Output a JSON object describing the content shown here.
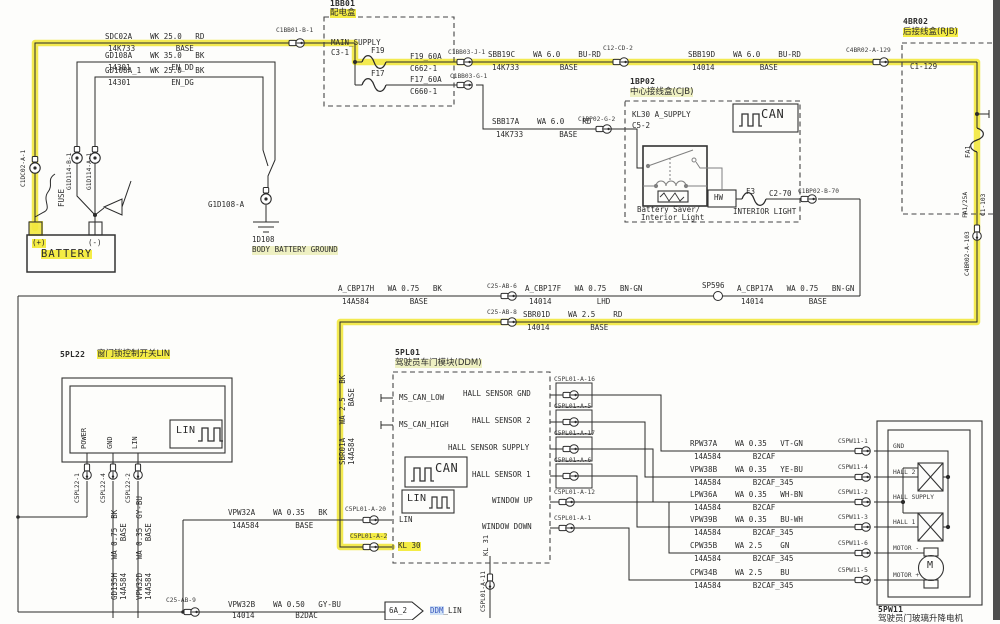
{
  "colors": {
    "highlight": "#f2e83d",
    "highlight_soft": "#eef0c2",
    "wire": "#2a2a2a",
    "link_blue": "#3d5bc0"
  },
  "tl": {
    "sdc02a_l1": "SDC02A    WK 25.0   RD",
    "sdc02a_l2": "14K733         BASE",
    "gd108a_l1": "GD108A    WK 35.0   BK",
    "gd108a_l2": "14301         EN_DD",
    "gd108a1_l1": "GD108A_1  WK 25.0   BK",
    "gd108a1_l2": "14301         EN_DG",
    "conn_top": "C1BB01-B-1",
    "conn_bat_pos": "C1DC02-A-1",
    "fuse": "FUSE",
    "conn_gnd_b": "G1D114-B-1",
    "conn_gnd_a": "G1D114-A-1",
    "bat_pos": "(+)",
    "bat_neg": "(-)",
    "battery": "BATTERY",
    "gnd_ring": "G1D108-A",
    "gnd_id": "1D108",
    "gnd_name": "BODY BATTERY GROUND"
  },
  "bb01": {
    "id": "1BB01",
    "name": "配电盒",
    "main": "MAIN_SUPPLY",
    "pin": "C3-1",
    "f19": "F19",
    "f19_spec": "F19_60A",
    "f19_conn": "C662-1",
    "f17": "F17",
    "f17_spec": "F17_60A",
    "f17_conn": "C660-1",
    "conn_j": "C1BB03-J-1",
    "conn_g": "C1BB03-G-1"
  },
  "feed": {
    "sbb19c_l1": "SBB19C    WA 6.0    BU-RD",
    "sbb19c_l2": "14K733         BASE",
    "conn_c12": "C12-CD-2",
    "sbb19d_l1": "SBB19D    WA 6.0    BU-RD",
    "sbb19d_l2": "14014          BASE",
    "conn_rjb": "C4BR02-A-129",
    "sbb17a_l1": "SBB17A    WA 6.0    RD",
    "sbb17a_l2": "14K733        BASE",
    "conn_cjb": "C1BP02-G-2"
  },
  "rjb": {
    "id": "4BR02",
    "name": "后接线盒(RJB)",
    "pin": "C1-129",
    "fuse": "FA1",
    "fuse_spec": "FA1/25A",
    "pin2": "C1-103",
    "conn": "C4BR02-A-103"
  },
  "cjb": {
    "id": "1BP02",
    "name": "中心接线盒(CJB)",
    "supply": "KL30 A_SUPPLY",
    "pin": "C5-2",
    "can": "CAN",
    "relay1": "Battery Saver/",
    "relay2": "Interior Light",
    "hw": "HW",
    "f3": "F3",
    "pin2": "C2-70",
    "light": "INTERIOR LIGHT",
    "conn": "C1BP02-B-70"
  },
  "mid": {
    "h_l1": "A_CBP17H   WA 0.75   BK",
    "h_l2": "14A584         BASE",
    "conn6": "C25-AB-6",
    "f_l1": "A_CBP17F   WA 0.75   BN-GN",
    "f_l2": "14014          LHD",
    "splice": "SP596",
    "a_l1": "A_CBP17A   WA 0.75   BN-GN",
    "a_l2": "14014          BASE",
    "conn8": "C25-AB-8",
    "d_l1": "SBR01D    WA 2.5    RD",
    "d_l2": "14014         BASE"
  },
  "spl22": {
    "id": "5PL22",
    "name": "窗门锁控制开关LIN",
    "pin_power": "POWER",
    "pin_gnd": "GND",
    "pin_lin": "LIN",
    "lin": "LIN",
    "conn1": "C5PL22-1",
    "conn4": "C5PL22-4",
    "conn2": "C5PL22-2",
    "gd_l1": "GD135H   WA 0.75  BK",
    "gd_l2": "14A584       BASE",
    "vd_l1": "VPW32D   WA 0.35  GY-BU",
    "vd_l2": "14A584       BASE"
  },
  "ddm": {
    "id": "5PL01",
    "name": "驾驶员车门模块(DDM)",
    "can_low": "MS_CAN_LOW",
    "can_high": "MS_CAN_HIGH",
    "p1": "HALL SENSOR GND",
    "p2": "HALL SENSOR 2",
    "p3": "HALL SENSOR SUPPLY",
    "p4": "HALL SENSOR 1",
    "p5": "WINDOW UP",
    "p6": "WINDOW DOWN",
    "can": "CAN",
    "lin_box": "LIN",
    "lin_pin": "LIN",
    "kl30": "KL 30",
    "kl31": "KL 31",
    "c1": "C5PL01-A-16",
    "c2": "C5PL01-A-5",
    "c3": "C5PL01-A-17",
    "c4": "C5PL01-A-6",
    "c5": "C5PL01-A-12",
    "c6": "C5PL01-A-1",
    "c_lin": "C5PL01-A-20",
    "c_kl30": "C5PL01-A-2",
    "c_kl31": "C5PL01-A-11",
    "sbr_l1": "SBR01A   WA 2.5   BK",
    "sbr_l2": "14A584       BASE"
  },
  "bottom": {
    "a_l1": "VPW32A    WA 0.35   BK",
    "a_l2": "14A584        BASE",
    "conn9": "C25-AB-9",
    "b_l1": "VPW32B    WA 0.50   GY-BU",
    "b_l2": "14014         B2DAC",
    "arrow": "6A_2",
    "ref_hl": "DDM",
    "ref_rest": "_LIN"
  },
  "right": {
    "wires": [
      {
        "l1": "RPW37A    WA 0.35   VT-GN",
        "l2": "14A584       B2CAF",
        "conn": "C5PW11-1"
      },
      {
        "l1": "VPW38B    WA 0.35   YE-BU",
        "l2": "14A584       B2CAF_345",
        "conn": "C5PW11-4"
      },
      {
        "l1": "LPW36A    WA 0.35   WH-BN",
        "l2": "14A584       B2CAF",
        "conn": "C5PW11-2"
      },
      {
        "l1": "VPW39B    WA 0.35   BU-WH",
        "l2": "14A584       B2CAF_345",
        "conn": "C5PW11-3"
      },
      {
        "l1": "CPW35B    WA 2.5    GN",
        "l2": "14A584       B2CAF_345",
        "conn": "C5PW11-6"
      },
      {
        "l1": "CPW34B    WA 2.5    BU",
        "l2": "14A584       B2CAF_345",
        "conn": "C5PW11-5"
      }
    ]
  },
  "pw11": {
    "id": "5PW11",
    "name": "驾驶员门玻璃升降电机",
    "pin1": "GND",
    "pin2": "HALL 2",
    "pin3": "HALL SUPPLY",
    "pin4": "HALL 1",
    "pin5": "MOTOR -",
    "pin6": "MOTOR +",
    "motor": "M"
  }
}
